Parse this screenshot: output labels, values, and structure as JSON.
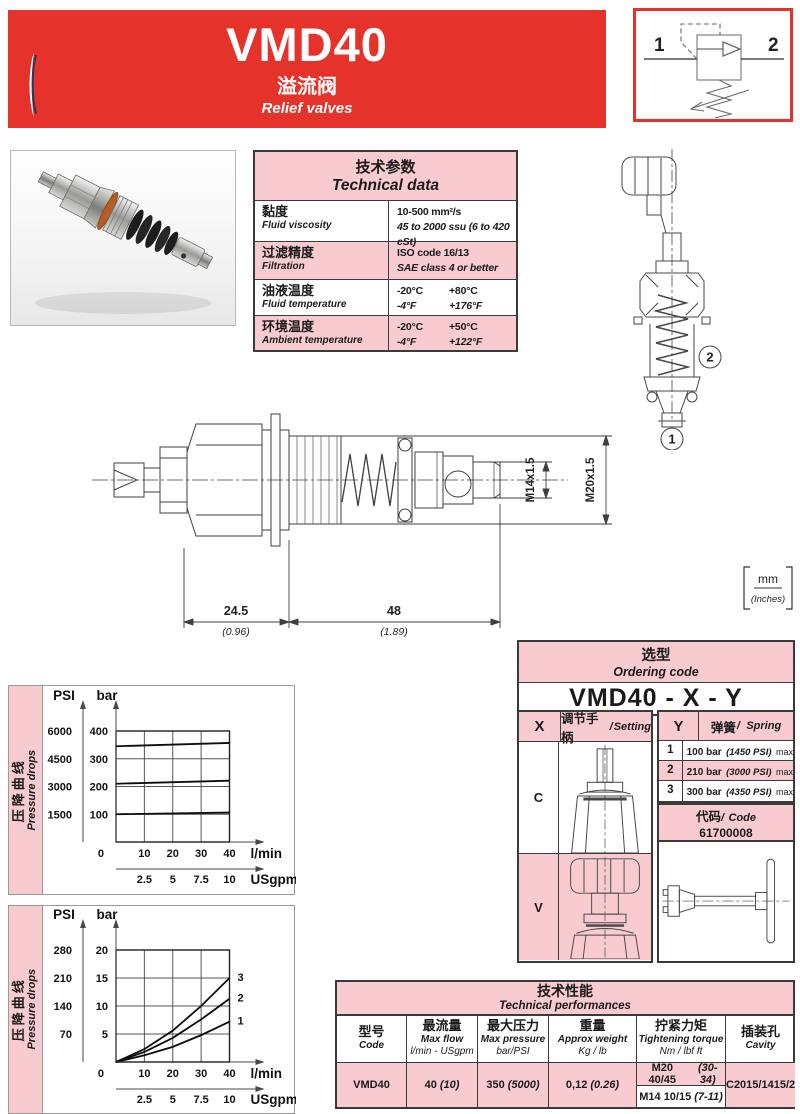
{
  "colors": {
    "red": "#e5332c",
    "pink": "#f8cbd1",
    "border": "#3a3a3a",
    "navy": "#2d4156"
  },
  "header": {
    "model": "VMD40",
    "subtitle_cn": "溢流阀",
    "subtitle_en": "Relief valves"
  },
  "symbol": {
    "port_left": "1",
    "port_right": "2"
  },
  "technical_data": {
    "title_cn": "技术参数",
    "title_en": "Technical data",
    "rows": [
      {
        "label_cn": "黏度",
        "label_en": "Fluid viscosity",
        "v1": "10-500 mm²/s",
        "v2": "45 to 2000 ssu (6 to 420 cSt)"
      },
      {
        "label_cn": "过滤精度",
        "label_en": "Filtration",
        "v1": "ISO code 16/13",
        "v2": "SAE class 4 or better"
      },
      {
        "label_cn": "油液温度",
        "label_en": "Fluid temperature",
        "v1a": "-20°C",
        "v1b": "+80°C",
        "v2a": "-4°F",
        "v2b": "+176°F"
      },
      {
        "label_cn": "环境温度",
        "label_en": "Ambient temperature",
        "v1a": "-20°C",
        "v1b": "+50°C",
        "v2a": "-4°F",
        "v2b": "+122°F"
      }
    ]
  },
  "drawing": {
    "callout_1": "1",
    "callout_2": "2",
    "dim_a_mm": "24.5",
    "dim_a_in": "(0.96)",
    "dim_b_mm": "48",
    "dim_b_in": "(1.89)",
    "thread_small": "M14x1.5",
    "thread_large": "M20x1.5",
    "units_mm": "mm",
    "units_in": "(Inches)"
  },
  "ordering": {
    "title_cn": "选型",
    "title_en": "Ordering code",
    "pattern": "VMD40 - X - Y",
    "sep": "/",
    "x_col": "X",
    "x_label_cn": "调节手柄",
    "x_label_en": "Setting",
    "x_options": [
      {
        "code": "C"
      },
      {
        "code": "V"
      }
    ],
    "y_col": "Y",
    "y_label_cn": "弹簧",
    "y_label_en": "Spring",
    "y_options": [
      {
        "code": "1",
        "pressure": "100 bar",
        "psi": "(1450 PSI)",
        "max": "max"
      },
      {
        "code": "2",
        "pressure": "210 bar",
        "psi": "(3000 PSI)",
        "max": "max"
      },
      {
        "code": "3",
        "pressure": "300 bar",
        "psi": "(4350 PSI)",
        "max": "max"
      }
    ],
    "code_label_cn": "代码",
    "code_label_en": "Code",
    "code_value": "61700008"
  },
  "performances": {
    "title_cn": "技术性能",
    "title_en": "Technical performances",
    "columns": [
      {
        "cn": "型号",
        "en": "Code",
        "sub": ""
      },
      {
        "cn": "最流量",
        "en": "Max flow",
        "sub": "l/min - USgpm"
      },
      {
        "cn": "最大压力",
        "en": "Max pressure",
        "sub": "bar/PSI"
      },
      {
        "cn": "重量",
        "en": "Approx weight",
        "sub": "Kg / lb"
      },
      {
        "cn": "拧紧力矩",
        "en": "Tightening torque",
        "sub": "Nm / lbf ft"
      },
      {
        "cn": "插装孔",
        "en": "Cavity",
        "sub": ""
      }
    ],
    "row": {
      "code": "VMD40",
      "flow": "40",
      "flow_paren": "(10)",
      "pressure": "350",
      "pressure_paren": "(5000)",
      "weight": "0,12",
      "weight_paren": "(0.26)",
      "torque1": "M20 40/45",
      "torque1_paren": "(30-34)",
      "torque2": "M14 10/15",
      "torque2_paren": "(7-11)",
      "cavity": "C2015/1415/2"
    }
  },
  "chart_data": [
    {
      "type": "line",
      "title_cn": "压降曲线",
      "title_en": "Pressure drops",
      "x_axis": {
        "label": "l/min",
        "ticks": [
          10,
          20,
          30,
          40
        ],
        "range": [
          0,
          40
        ],
        "origin": "0",
        "secondary_label": "USgpm",
        "secondary_ticks": [
          2.5,
          5,
          7.5,
          10
        ]
      },
      "y_axis": {
        "label": "bar",
        "ticks": [
          100,
          200,
          300,
          400
        ],
        "range": [
          0,
          400
        ],
        "secondary_label": "PSI",
        "secondary_ticks": [
          1500,
          3000,
          4500,
          6000
        ]
      },
      "grid": true,
      "legend": "none",
      "series": [
        {
          "label": "",
          "x": [
            0,
            40
          ],
          "y": [
            345,
            357
          ]
        },
        {
          "label": "",
          "x": [
            0,
            40
          ],
          "y": [
            210,
            221
          ]
        },
        {
          "label": "",
          "x": [
            0,
            40
          ],
          "y": [
            100,
            106
          ]
        }
      ]
    },
    {
      "type": "line",
      "title_cn": "压降曲线",
      "title_en": "Pressure drops",
      "x_axis": {
        "label": "l/min",
        "ticks": [
          10,
          20,
          30,
          40
        ],
        "range": [
          0,
          40
        ],
        "origin": "0",
        "secondary_label": "USgpm",
        "secondary_ticks": [
          2.5,
          5,
          7.5,
          10
        ]
      },
      "y_axis": {
        "label": "bar",
        "ticks": [
          5,
          10,
          15,
          20
        ],
        "range": [
          0,
          20
        ],
        "secondary_label": "PSI",
        "secondary_ticks": [
          70,
          140,
          210,
          280
        ]
      },
      "grid": true,
      "legend": "inline-end-labels",
      "series": [
        {
          "label": "3",
          "x": [
            0,
            10,
            20,
            30,
            40
          ],
          "y": [
            0,
            2.3,
            5.6,
            10,
            15
          ]
        },
        {
          "label": "2",
          "x": [
            0,
            10,
            20,
            30,
            40
          ],
          "y": [
            0,
            1.8,
            4.3,
            7.6,
            11.3
          ]
        },
        {
          "label": "1",
          "x": [
            0,
            10,
            20,
            30,
            40
          ],
          "y": [
            0,
            1.2,
            2.7,
            4.8,
            7.2
          ]
        }
      ]
    }
  ]
}
